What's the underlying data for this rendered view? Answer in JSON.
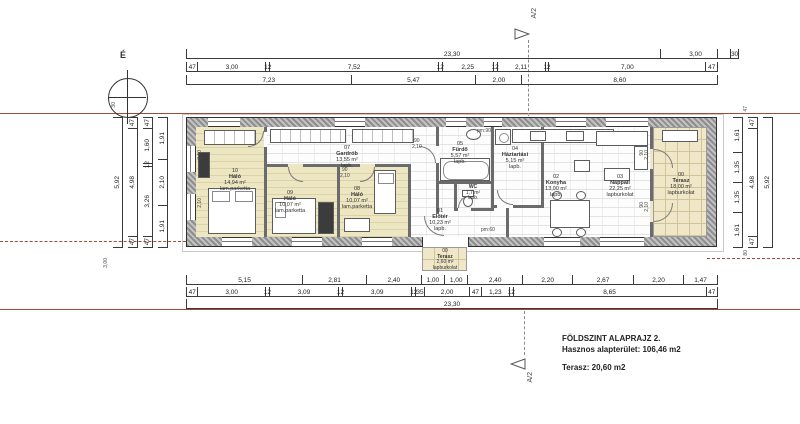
{
  "meta": {
    "north_label": "É",
    "section_marker": "A/2"
  },
  "title_block": {
    "line1": "FÖLDSZINT ALAPRAJZ 2.",
    "line2": "Hasznos alapterület: 106,46 m2",
    "line3": "Terasz: 20,60 m2"
  },
  "rooms": [
    {
      "num": "10",
      "name": "Háló",
      "area": "14,94 m²",
      "floor": "lam.parketta"
    },
    {
      "num": "09",
      "name": "Háló",
      "area": "10,07 m²",
      "floor": "lam.parketta"
    },
    {
      "num": "08",
      "name": "Háló",
      "area": "10,07 m²",
      "floor": "lam.parketta"
    },
    {
      "num": "07",
      "name": "Gardrób",
      "area": "13,55 m²",
      "floor": "lapb."
    },
    {
      "num": "05",
      "name": "Fürdő",
      "area": "5,57 m²",
      "floor": "lapb."
    },
    {
      "num": "06",
      "name": "WC",
      "area": "1,7 m²",
      "floor": "lapb."
    },
    {
      "num": "04",
      "name": "Háztartási",
      "area": "5,15 m²",
      "floor": "lapb."
    },
    {
      "num": "01",
      "name": "Előtér",
      "area": "10,23 m²",
      "floor": "lapb."
    },
    {
      "num": "02",
      "name": "Konyha",
      "area": "13,00 m²",
      "floor": "lapb."
    },
    {
      "num": "03",
      "name": "Nappali",
      "area": "22,25 m²",
      "floor": "lapburkolat"
    },
    {
      "num": "00",
      "name": "Terasz",
      "area": "18,00 m²",
      "floor": "lapburkolat"
    },
    {
      "num": "00",
      "name": "Terasz",
      "area": "2,60 m²",
      "floor": "lapburkolat"
    }
  ],
  "dimensions": {
    "top_total": [
      "23,30"
    ],
    "top_main": [
      "47",
      "3,00",
      "12",
      "7,52",
      "12",
      "2,25",
      "12",
      "2,11",
      "12",
      "7,00",
      "47"
    ],
    "top_ext": [
      "3,00",
      "30"
    ],
    "top_sub": [
      "7,23",
      "5,47",
      "2,00",
      "8,60"
    ],
    "bottom_upper": [
      "5,15",
      "2,81",
      "2,40",
      "1,00",
      "1,00",
      "2,40",
      "2,20",
      "2,67",
      "2,20",
      "1,47"
    ],
    "bottom_main": [
      "47",
      "3,00",
      "12",
      "3,09",
      "12",
      "3,09",
      "12",
      "35",
      "2,00",
      "47",
      "1,23",
      "12",
      "8,65",
      "47"
    ],
    "bottom_total": [
      "23,30"
    ],
    "left_outer": [
      "5,92"
    ],
    "left_mid": [
      "47",
      "4,98",
      "47"
    ],
    "left_inner2": [
      "47",
      "1,60",
      "12",
      "3,26",
      "47"
    ],
    "left_inner1": [
      "1,91",
      "2,10",
      "1,91"
    ],
    "right_inner": [
      "1,61",
      "1,35",
      "1,35",
      "1,61"
    ],
    "right_mid": [
      "47",
      "4,98",
      "47"
    ],
    "right_outer": [
      "5,92"
    ]
  },
  "tags": [
    "30",
    "3,00",
    "80",
    "47",
    "2,10",
    "2,10",
    "pm:90",
    "pm:60",
    "90",
    "2,10",
    "90",
    "2,10",
    "90",
    "2,10",
    "90",
    "2,10"
  ]
}
